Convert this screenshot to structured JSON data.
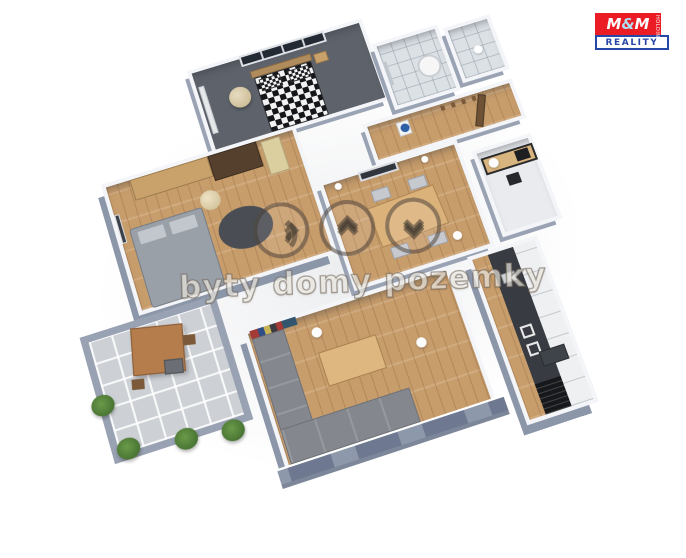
{
  "scene": {
    "description": "3D rendered isometric floor plan of an apartment on a white background",
    "background_color": "#ffffff",
    "colors": {
      "exterior_wall": "#8e98ab",
      "interior_wall_top": "#f3f5f8",
      "wood_floor": "#c89d6c",
      "dark_bedroom_floor": "#5e626a",
      "bathroom_tile": "#dce1e6",
      "balcony_tile": "#cdd1d6",
      "kitchen_counter": "#383b41",
      "sofa_gray": "#84878d",
      "plant_green": "#4a7c3f"
    },
    "rooms": [
      {
        "id": "bedroom-1",
        "floor": "dark-gray",
        "furniture": [
          "checkered-double-bed",
          "window",
          "radiator",
          "round-lamp",
          "nightstand"
        ]
      },
      {
        "id": "bathroom",
        "floor": "white-tile",
        "furniture": [
          "water-heater",
          "mirror"
        ]
      },
      {
        "id": "wc",
        "floor": "white-tile",
        "furniture": [
          "ceiling-light"
        ]
      },
      {
        "id": "hallway",
        "floor": "wood",
        "furniture": [
          "washbasin-blue-bowl",
          "coat-hooks",
          "open-door"
        ]
      },
      {
        "id": "bedroom-2",
        "floor": "wood",
        "furniture": [
          "wardrobe-light",
          "wardrobe-dark",
          "shelf",
          "gray-double-bed",
          "round-rug",
          "round-lamp",
          "wall-picture"
        ]
      },
      {
        "id": "dining-room",
        "floor": "wood",
        "furniture": [
          "dining-table",
          "four-chairs",
          "wall-picture",
          "wall-sconces"
        ]
      },
      {
        "id": "study",
        "floor": "light",
        "furniture": [
          "desk",
          "monitor",
          "chair"
        ]
      },
      {
        "id": "living-room",
        "floor": "wood",
        "furniture": [
          "corner-sofa",
          "coffee-table",
          "bookshelf",
          "ceiling-lights"
        ]
      },
      {
        "id": "kitchen",
        "floor": "wood-strip",
        "furniture": [
          "dark-counter",
          "sink",
          "induction-hob",
          "fridge",
          "white-cabinets",
          "peninsula"
        ]
      },
      {
        "id": "balcony",
        "floor": "gray-tile",
        "furniture": [
          "parasol",
          "bistro-table",
          "chairs",
          "plants"
        ]
      }
    ]
  },
  "watermark": {
    "text": "byty domy pozemky",
    "icons": [
      "signal-waves-icon",
      "chevrons-up-icon",
      "chevrons-down-icon"
    ]
  },
  "logo": {
    "m1": "M",
    "amp": "&",
    "m2": "M",
    "side": "HOLDING",
    "bottom": "REALITY",
    "red": "#ec1c24",
    "blue": "#2646a8"
  }
}
